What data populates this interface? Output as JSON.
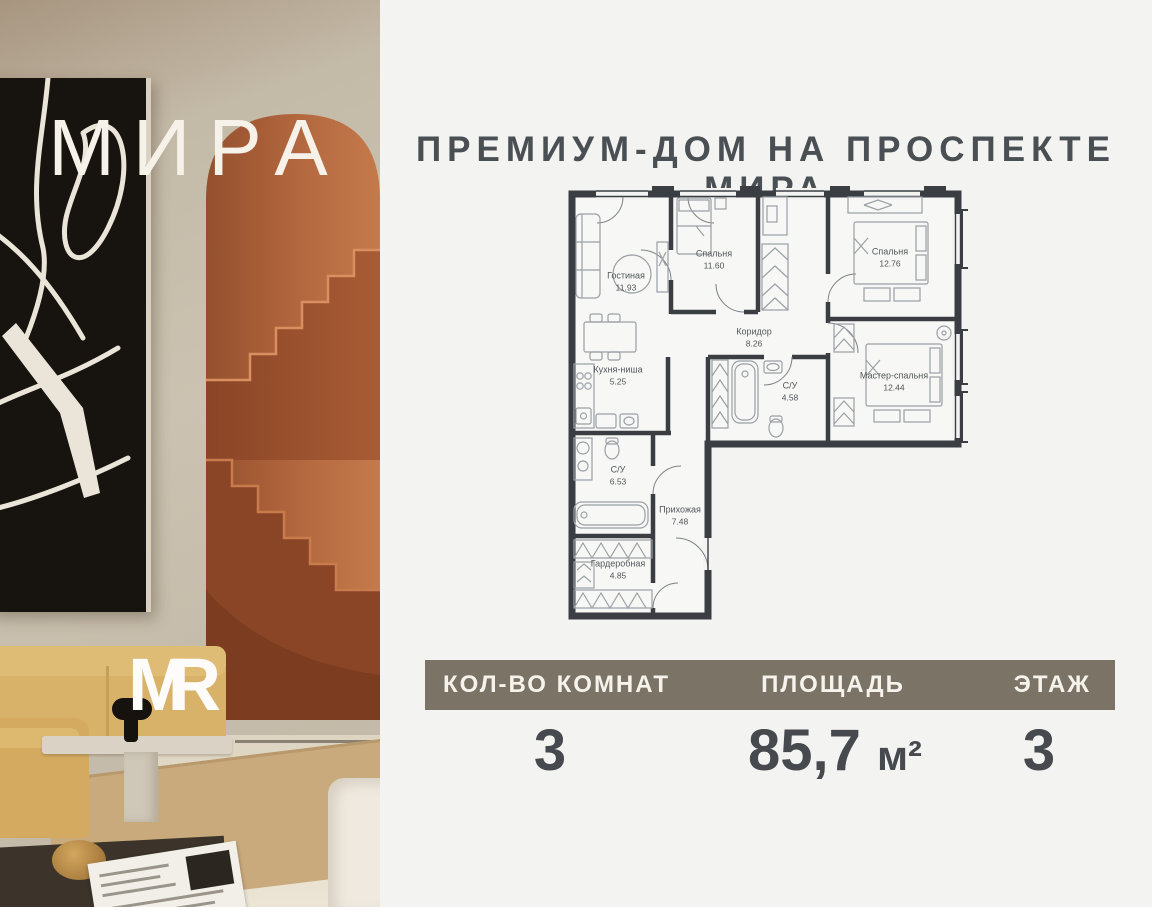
{
  "photo": {
    "wordmark": "МИРА",
    "logo": {
      "m": "M",
      "r": "R"
    }
  },
  "header": {
    "title": "ПРЕМИУМ-ДОМ НА ПРОСПЕКТЕ МИРА"
  },
  "floor_plan": {
    "rooms": [
      {
        "name": "Гостиная",
        "area": "11.93",
        "x": 58,
        "y": 96
      },
      {
        "name": "Спальня",
        "area": "11.60",
        "x": 146,
        "y": 74
      },
      {
        "name": "Спальня",
        "area": "12.76",
        "x": 322,
        "y": 72
      },
      {
        "name": "Коридор",
        "area": "8.26",
        "x": 186,
        "y": 152
      },
      {
        "name": "Кухня-ниша",
        "area": "5.25",
        "x": 50,
        "y": 190
      },
      {
        "name": "С/У",
        "area": "4.58",
        "x": 222,
        "y": 206
      },
      {
        "name": "Мастер-спальня",
        "area": "12.44",
        "x": 326,
        "y": 196
      },
      {
        "name": "С/У",
        "area": "6.53",
        "x": 50,
        "y": 290
      },
      {
        "name": "Прихожая",
        "area": "7.48",
        "x": 112,
        "y": 330
      },
      {
        "name": "Гардеробная",
        "area": "4.85",
        "x": 50,
        "y": 384
      }
    ]
  },
  "summary": {
    "columns": [
      {
        "label": "КОЛ-ВО КОМНАТ",
        "value": "3"
      },
      {
        "label": "ПЛОЩАДЬ",
        "value": "85,7",
        "unit": "м²"
      },
      {
        "label": "ЭТАЖ",
        "value": "3"
      }
    ]
  },
  "colors": {
    "panel_bg": "#f3f3f1",
    "plan_wall": "#3a3e43",
    "summary_bar_bg": "#7b7366",
    "value_text": "#46494d",
    "terracotta": "#b0603a",
    "art_black": "#17130f",
    "sofa_yellow": "#d8b269"
  }
}
